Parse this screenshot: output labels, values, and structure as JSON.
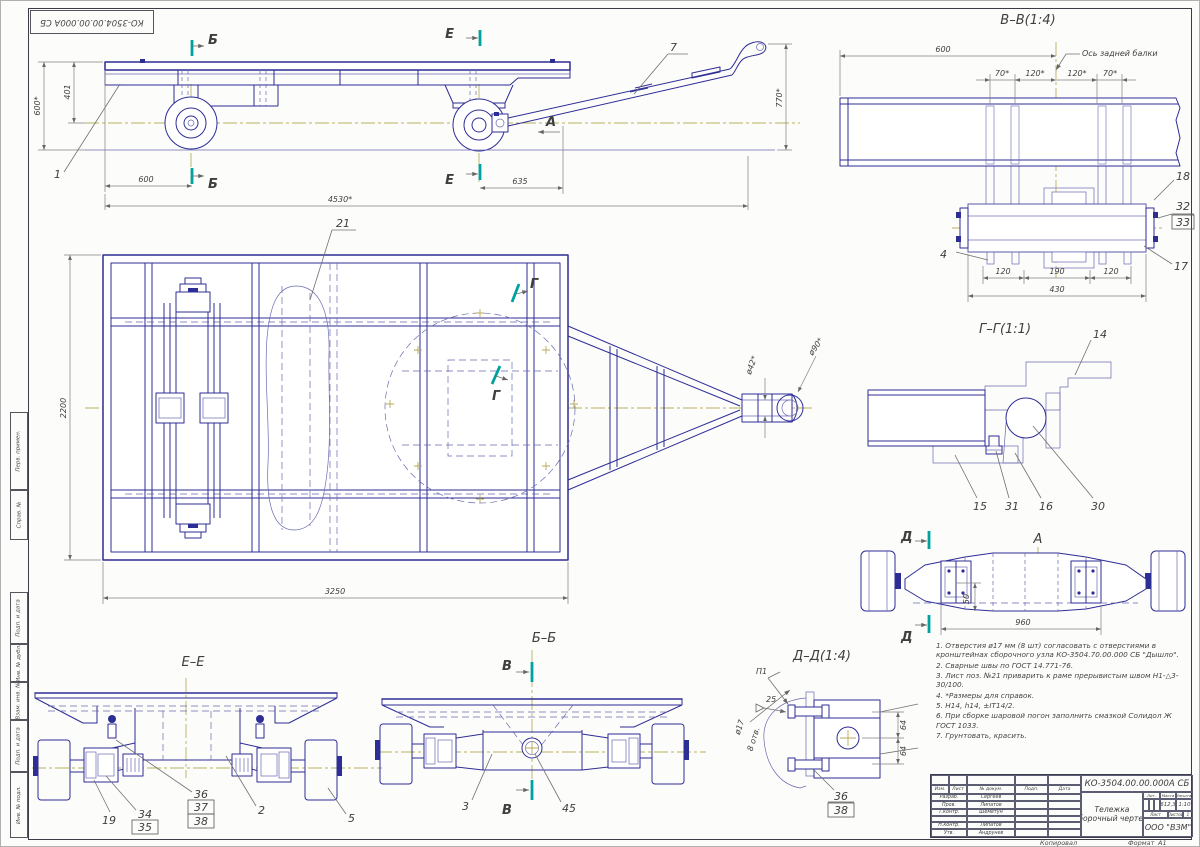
{
  "page": {
    "corner_stamp": "КО-3504.00.00.000А СБ",
    "margin_stamps": [
      "Перв. примен.",
      "Справ. №",
      "Подп. и дата",
      "Инв. № дубл.",
      "Взам. инв. №",
      "Подп. и дата",
      "Инв. № подл."
    ],
    "footer": {
      "copied": "Копировал",
      "format_label": "Формат",
      "format_value": "А1"
    }
  },
  "side_view": {
    "section_b": "Б",
    "section_e": "Е",
    "view_arrow": "А",
    "callout_1": "1",
    "callout_7": "7",
    "dim_height": "600*",
    "dim_401": "401",
    "dim_600": "600",
    "dim_635": "635",
    "dim_length": "4530*",
    "dim_770": "770*"
  },
  "plan_view": {
    "callout_21": "21",
    "section_g": "Г",
    "dim_2200": "2200",
    "dim_3250": "3250",
    "dim_d42": "ø42*",
    "dim_d90": "ø90*"
  },
  "section_vv": {
    "title": "В–В(1:4)",
    "axis_label": "Ось задней балки",
    "dim_600": "600",
    "dim_70_l": "70*",
    "dim_120_l": "120*",
    "dim_120_r": "120*",
    "dim_70_r": "70*",
    "dim_120_b1": "120",
    "dim_190": "190",
    "dim_120_b2": "120",
    "dim_430": "430",
    "callout_18": "18",
    "callout_32": "32",
    "callout_33": "33",
    "callout_17": "17",
    "callout_4": "4"
  },
  "section_gg": {
    "title": "Г–Г(1:1)",
    "callout_14": "14",
    "callout_15": "15",
    "callout_31": "31",
    "callout_16": "16",
    "callout_30": "30"
  },
  "view_a": {
    "title": "А",
    "section_d": "Д",
    "dim_50": "50",
    "dim_960": "960"
  },
  "section_ee": {
    "title": "Е–Е",
    "callout_19": "19",
    "callout_34": "34",
    "callout_35": "35",
    "callout_36": "36",
    "callout_37": "37",
    "callout_38": "38",
    "callout_2": "2",
    "callout_5": "5"
  },
  "section_bb": {
    "title": "Б–Б",
    "section_v": "В",
    "callout_3": "3",
    "callout_45": "45"
  },
  "section_dd": {
    "title": "Д–Д(1:4)",
    "weld_ref": "П1",
    "weld_size": "25",
    "dim_d17": "ø17",
    "dim_holes": "8 отв.",
    "dim_64_top": "64",
    "dim_64_bot": "64",
    "callout_36": "36",
    "callout_38": "38"
  },
  "notes": [
    "1. Отверстия ø17 мм (8 шт) согласовать с отверстиями в кронштейнах сборочного узла КО-3504.70.00.000 СБ \"Дышло\".",
    "2. Сварные швы по ГОСТ 14.771-76.",
    "3. Лист поз. №21 приварить к раме прерывистым швом Н1-△3-30/100.",
    "4. *Размеры для справок.",
    "5. Н14, h14, ±IT14/2.",
    "6. При сборке шаровой погон заполнить смазкой Солидол Ж ГОСТ 1033.",
    "7. Грунтовать, красить."
  ],
  "title_block": {
    "doc_number": "КО-3504.00.00.000А СБ",
    "product_line1": "Тележка",
    "product_line2": "сборочный чертеж",
    "company": "ООО \"ВЗМ\"",
    "mass": "612,3",
    "scale": "1:10",
    "lit_header": "Лит.",
    "mass_header": "Масса",
    "scale_header": "Масштаб",
    "sheet_header": "Лист",
    "sheets_header": "Листов",
    "sheets_value": "1",
    "col_izm": "Изм.",
    "col_list": "Лист",
    "col_doc": "№ докум.",
    "col_sign": "Подп.",
    "col_date": "Дата",
    "rows": [
      {
        "role": "Разраб.",
        "name": "Сергеев"
      },
      {
        "role": "Пров.",
        "name": "Липатов"
      },
      {
        "role": "Т.контр.",
        "name": "Шеметун"
      },
      {
        "role": "Н.контр.",
        "name": "Липатов"
      },
      {
        "role": "Утв.",
        "name": "Андрунев"
      }
    ]
  }
}
